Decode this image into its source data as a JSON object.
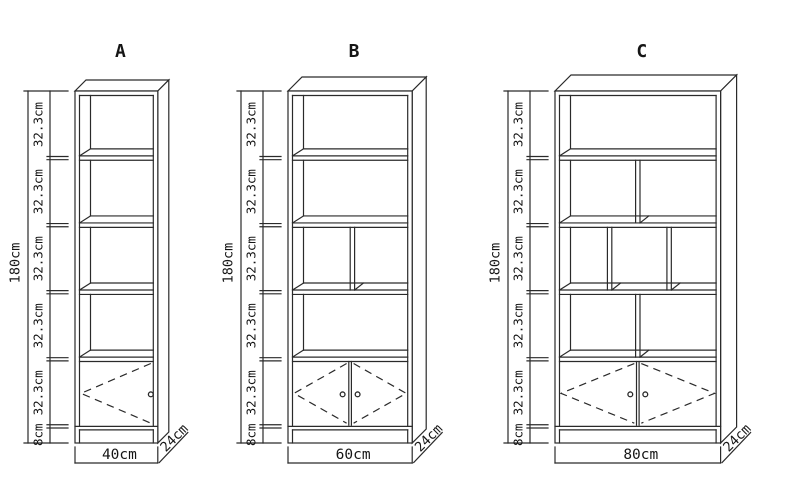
{
  "page": {
    "background": "#ffffff",
    "line_color": "#2a2a2a",
    "text_color": "#151515"
  },
  "diagram": {
    "height_label": "180cm",
    "depth_label": "24cm",
    "segment_labels": [
      "32.3cm",
      "32.3cm",
      "32.3cm",
      "32.3cm",
      "32.3cm",
      "8cm"
    ],
    "segments_cm": [
      32.3,
      32.3,
      32.3,
      32.3,
      32.3,
      8
    ],
    "cabinets": [
      {
        "label": "A",
        "width_label": "40cm",
        "width_cm": 40,
        "sections": [
          {
            "type": "open",
            "dividers": []
          },
          {
            "type": "open",
            "dividers": []
          },
          {
            "type": "open",
            "dividers": []
          },
          {
            "type": "open",
            "dividers": []
          },
          {
            "type": "doors",
            "door_count": 1
          }
        ]
      },
      {
        "label": "B",
        "width_label": "60cm",
        "width_cm": 60,
        "sections": [
          {
            "type": "open",
            "dividers": []
          },
          {
            "type": "open",
            "dividers": []
          },
          {
            "type": "divided",
            "dividers": [
              0.52
            ]
          },
          {
            "type": "open",
            "dividers": []
          },
          {
            "type": "doors",
            "door_count": 2
          }
        ]
      },
      {
        "label": "C",
        "width_label": "80cm",
        "width_cm": 80,
        "sections": [
          {
            "type": "open",
            "dividers": []
          },
          {
            "type": "divided",
            "dividers": [
              0.5
            ]
          },
          {
            "type": "divided",
            "dividers": [
              0.32,
              0.7
            ]
          },
          {
            "type": "divided",
            "dividers": [
              0.5
            ]
          },
          {
            "type": "doors",
            "door_count": 2
          }
        ]
      }
    ]
  }
}
